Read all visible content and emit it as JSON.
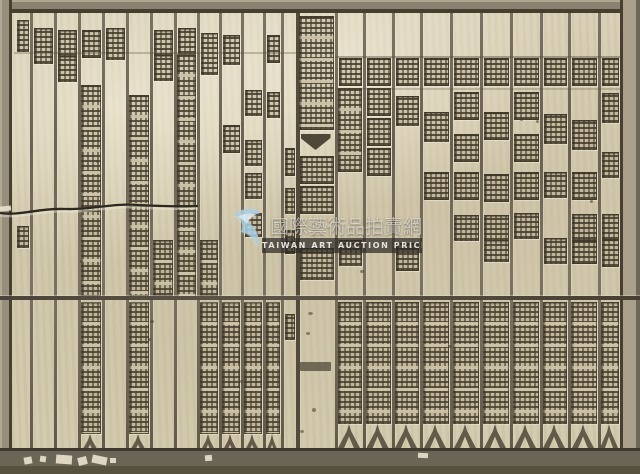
{
  "meta": {
    "description": "Photograph of an antique Chinese woodblock printing plate: a rectangular wooden board with a carved border frame, about two dozen vertical columns of mirrored relief characters, a central heading column with a fishtail mark, a horizontal joint seam across the middle, a crack at the upper left, and a semi-transparent watermark overlay in the center."
  },
  "palette": {
    "wood_base": "#d2c8ae",
    "wood_light": "#ddd4ba",
    "wood_shadow": "#bdb297",
    "frame_dark": "#463f2f",
    "border_top": "#8b8170",
    "border_right": "#aaa08c",
    "border_bottom": "#6b6555",
    "divider": "#5d5546",
    "glyph_dark": "#4e4636",
    "watermark_blue": "#a6cde0",
    "watermark_band": "#2e2b26"
  },
  "watermark": {
    "cn_text": "國際藝術品拍賣網",
    "en_text": "TAIWAN ART AUCTION PRICE",
    "legibility": "semi-transparent, partially legible"
  },
  "woodblock": {
    "seam_y": 296,
    "hlines": [
      {
        "x": 14,
        "y": 52,
        "w": 282,
        "o": 0.3
      },
      {
        "x": 335,
        "y": 56,
        "w": 285,
        "o": 0.45
      },
      {
        "x": 335,
        "y": 88,
        "w": 285,
        "o": 0.25
      }
    ],
    "columns": [
      {
        "x": 13,
        "w": 17,
        "segs": [
          {
            "t": "g",
            "y": 20,
            "h": 30
          },
          {
            "t": "g",
            "y": 226,
            "h": 20
          }
        ]
      },
      {
        "x": 30,
        "w": 24,
        "segs": [
          {
            "t": "g",
            "y": 28,
            "h": 34
          }
        ]
      },
      {
        "x": 54,
        "w": 24,
        "segs": [
          {
            "t": "g",
            "y": 30,
            "h": 24
          },
          {
            "t": "g",
            "y": 56,
            "h": 24
          }
        ]
      },
      {
        "x": 78,
        "w": 24,
        "segs": [
          {
            "t": "g",
            "y": 30,
            "h": 26
          },
          {
            "t": "r",
            "y": 85,
            "h": 211
          },
          {
            "t": "r",
            "y": 302,
            "h": 130
          },
          {
            "t": "f",
            "y": 434,
            "h": 20
          }
        ]
      },
      {
        "x": 102,
        "w": 24,
        "segs": [
          {
            "t": "g",
            "y": 28,
            "h": 30
          }
        ]
      },
      {
        "x": 126,
        "w": 24,
        "segs": [
          {
            "t": "r",
            "y": 95,
            "h": 201
          },
          {
            "t": "r",
            "y": 302,
            "h": 130
          },
          {
            "t": "f",
            "y": 434,
            "h": 20
          }
        ]
      },
      {
        "x": 150,
        "w": 24,
        "segs": [
          {
            "t": "g",
            "y": 30,
            "h": 24
          },
          {
            "t": "g",
            "y": 55,
            "h": 24
          },
          {
            "t": "r",
            "y": 240,
            "h": 54
          }
        ]
      },
      {
        "x": 174,
        "w": 23,
        "segs": [
          {
            "t": "g",
            "y": 28,
            "h": 24
          },
          {
            "t": "r",
            "y": 54,
            "h": 242
          }
        ]
      },
      {
        "x": 197,
        "w": 22,
        "segs": [
          {
            "t": "g",
            "y": 33,
            "h": 40
          },
          {
            "t": "r",
            "y": 240,
            "h": 54
          },
          {
            "t": "r",
            "y": 302,
            "h": 130
          },
          {
            "t": "f",
            "y": 434,
            "h": 20
          }
        ]
      },
      {
        "x": 219,
        "w": 22,
        "segs": [
          {
            "t": "g",
            "y": 35,
            "h": 28
          },
          {
            "t": "g",
            "y": 125,
            "h": 26
          },
          {
            "t": "r",
            "y": 302,
            "h": 130
          },
          {
            "t": "f",
            "y": 434,
            "h": 20
          }
        ]
      },
      {
        "x": 241,
        "w": 22,
        "segs": [
          {
            "t": "g",
            "y": 90,
            "h": 24
          },
          {
            "t": "g",
            "y": 140,
            "h": 24
          },
          {
            "t": "g",
            "y": 173,
            "h": 24
          },
          {
            "t": "g",
            "y": 213,
            "h": 22
          },
          {
            "t": "r",
            "y": 302,
            "h": 130
          },
          {
            "t": "f",
            "y": 434,
            "h": 20
          }
        ]
      },
      {
        "x": 263,
        "w": 18,
        "segs": [
          {
            "t": "g",
            "y": 35,
            "h": 26
          },
          {
            "t": "g",
            "y": 92,
            "h": 24
          },
          {
            "t": "r",
            "y": 302,
            "h": 130
          },
          {
            "t": "f",
            "y": 434,
            "h": 20
          }
        ]
      },
      {
        "x": 281,
        "w": 15,
        "segs": [
          {
            "t": "g",
            "y": 148,
            "h": 26
          },
          {
            "t": "g",
            "y": 188,
            "h": 24
          },
          {
            "t": "g",
            "y": 230,
            "h": 22
          },
          {
            "t": "g",
            "y": 314,
            "h": 24
          }
        ]
      },
      {
        "x": 296,
        "w": 39,
        "center": true,
        "segs": [
          {
            "t": "r",
            "y": 16,
            "h": 112
          },
          {
            "t": "fish",
            "y": 134,
            "h": 16
          },
          {
            "t": "g",
            "y": 156,
            "h": 26
          },
          {
            "t": "g",
            "y": 186,
            "h": 26
          },
          {
            "t": "g",
            "y": 248,
            "h": 30
          },
          {
            "t": "bar",
            "y": 362,
            "h": 9
          }
        ]
      },
      {
        "x": 335,
        "w": 28,
        "segs": [
          {
            "t": "g",
            "y": 58,
            "h": 26
          },
          {
            "t": "r",
            "y": 88,
            "h": 82
          },
          {
            "t": "g",
            "y": 240,
            "h": 24
          },
          {
            "t": "r",
            "y": 302,
            "h": 120
          },
          {
            "t": "f",
            "y": 424,
            "h": 24
          }
        ]
      },
      {
        "x": 363,
        "w": 29,
        "segs": [
          {
            "t": "g",
            "y": 58,
            "h": 26
          },
          {
            "t": "g",
            "y": 88,
            "h": 26
          },
          {
            "t": "g",
            "y": 118,
            "h": 26
          },
          {
            "t": "g",
            "y": 148,
            "h": 26
          },
          {
            "t": "r",
            "y": 302,
            "h": 120
          },
          {
            "t": "f",
            "y": 424,
            "h": 24
          }
        ]
      },
      {
        "x": 392,
        "w": 28,
        "segs": [
          {
            "t": "g",
            "y": 58,
            "h": 26
          },
          {
            "t": "g",
            "y": 96,
            "h": 28
          },
          {
            "t": "g",
            "y": 243,
            "h": 26
          },
          {
            "t": "r",
            "y": 302,
            "h": 120
          },
          {
            "t": "f",
            "y": 424,
            "h": 24
          }
        ]
      },
      {
        "x": 420,
        "w": 30,
        "segs": [
          {
            "t": "g",
            "y": 58,
            "h": 26
          },
          {
            "t": "g",
            "y": 112,
            "h": 28
          },
          {
            "t": "g",
            "y": 172,
            "h": 26
          },
          {
            "t": "r",
            "y": 302,
            "h": 120
          },
          {
            "t": "f",
            "y": 424,
            "h": 24
          }
        ]
      },
      {
        "x": 450,
        "w": 30,
        "segs": [
          {
            "t": "g",
            "y": 58,
            "h": 26
          },
          {
            "t": "g",
            "y": 92,
            "h": 26
          },
          {
            "t": "g",
            "y": 134,
            "h": 26
          },
          {
            "t": "g",
            "y": 172,
            "h": 26
          },
          {
            "t": "g",
            "y": 215,
            "h": 24
          },
          {
            "t": "r",
            "y": 302,
            "h": 120
          },
          {
            "t": "f",
            "y": 424,
            "h": 24
          }
        ]
      },
      {
        "x": 480,
        "w": 30,
        "segs": [
          {
            "t": "g",
            "y": 58,
            "h": 26
          },
          {
            "t": "g",
            "y": 112,
            "h": 26
          },
          {
            "t": "g",
            "y": 174,
            "h": 26
          },
          {
            "t": "g",
            "y": 215,
            "h": 24
          },
          {
            "t": "g",
            "y": 240,
            "h": 20
          },
          {
            "t": "r",
            "y": 302,
            "h": 120
          },
          {
            "t": "f",
            "y": 424,
            "h": 24
          }
        ]
      },
      {
        "x": 510,
        "w": 30,
        "segs": [
          {
            "t": "g",
            "y": 58,
            "h": 26
          },
          {
            "t": "g",
            "y": 92,
            "h": 26
          },
          {
            "t": "g",
            "y": 134,
            "h": 26
          },
          {
            "t": "g",
            "y": 172,
            "h": 26
          },
          {
            "t": "g",
            "y": 213,
            "h": 24
          },
          {
            "t": "r",
            "y": 302,
            "h": 120
          },
          {
            "t": "f",
            "y": 424,
            "h": 24
          }
        ]
      },
      {
        "x": 540,
        "w": 28,
        "segs": [
          {
            "t": "g",
            "y": 58,
            "h": 26
          },
          {
            "t": "g",
            "y": 114,
            "h": 28
          },
          {
            "t": "g",
            "y": 172,
            "h": 24
          },
          {
            "t": "g",
            "y": 238,
            "h": 24
          },
          {
            "t": "r",
            "y": 302,
            "h": 120
          },
          {
            "t": "f",
            "y": 424,
            "h": 24
          }
        ]
      },
      {
        "x": 568,
        "w": 30,
        "segs": [
          {
            "t": "g",
            "y": 58,
            "h": 26
          },
          {
            "t": "g",
            "y": 120,
            "h": 28
          },
          {
            "t": "g",
            "y": 172,
            "h": 26
          },
          {
            "t": "g",
            "y": 214,
            "h": 24
          },
          {
            "t": "g",
            "y": 240,
            "h": 22
          },
          {
            "t": "r",
            "y": 302,
            "h": 120
          },
          {
            "t": "f",
            "y": 424,
            "h": 24
          }
        ]
      },
      {
        "x": 598,
        "w": 22,
        "segs": [
          {
            "t": "g",
            "y": 58,
            "h": 26
          },
          {
            "t": "g",
            "y": 93,
            "h": 28
          },
          {
            "t": "g",
            "y": 152,
            "h": 24
          },
          {
            "t": "g",
            "y": 214,
            "h": 24
          },
          {
            "t": "g",
            "y": 239,
            "h": 26
          },
          {
            "t": "r",
            "y": 302,
            "h": 120
          },
          {
            "t": "f",
            "y": 424,
            "h": 24
          }
        ]
      }
    ],
    "specks": [
      [
        150,
        320,
        4,
        3
      ],
      [
        148,
        338,
        3,
        3
      ],
      [
        308,
        312,
        5,
        3
      ],
      [
        306,
        332,
        4,
        3
      ],
      [
        312,
        408,
        4,
        4
      ],
      [
        520,
        118,
        3,
        3
      ],
      [
        80,
        260,
        3,
        3
      ],
      [
        360,
        270,
        4,
        3
      ],
      [
        590,
        200,
        3,
        3
      ],
      [
        240,
        380,
        3,
        3
      ],
      [
        448,
        345,
        4,
        3
      ],
      [
        300,
        430,
        4,
        3
      ],
      [
        536,
        120,
        3,
        3
      ],
      [
        96,
        160,
        3,
        3
      ]
    ],
    "chips": [
      [
        24,
        457,
        8,
        7,
        -10
      ],
      [
        40,
        456,
        6,
        6,
        8
      ],
      [
        56,
        455,
        16,
        9,
        4
      ],
      [
        78,
        457,
        9,
        8,
        -14
      ],
      [
        92,
        456,
        15,
        8,
        12
      ],
      [
        110,
        458,
        6,
        5,
        0
      ],
      [
        205,
        455,
        7,
        6,
        -5
      ],
      [
        418,
        453,
        10,
        5,
        3
      ],
      [
        0,
        206,
        11,
        5,
        -6
      ]
    ]
  }
}
